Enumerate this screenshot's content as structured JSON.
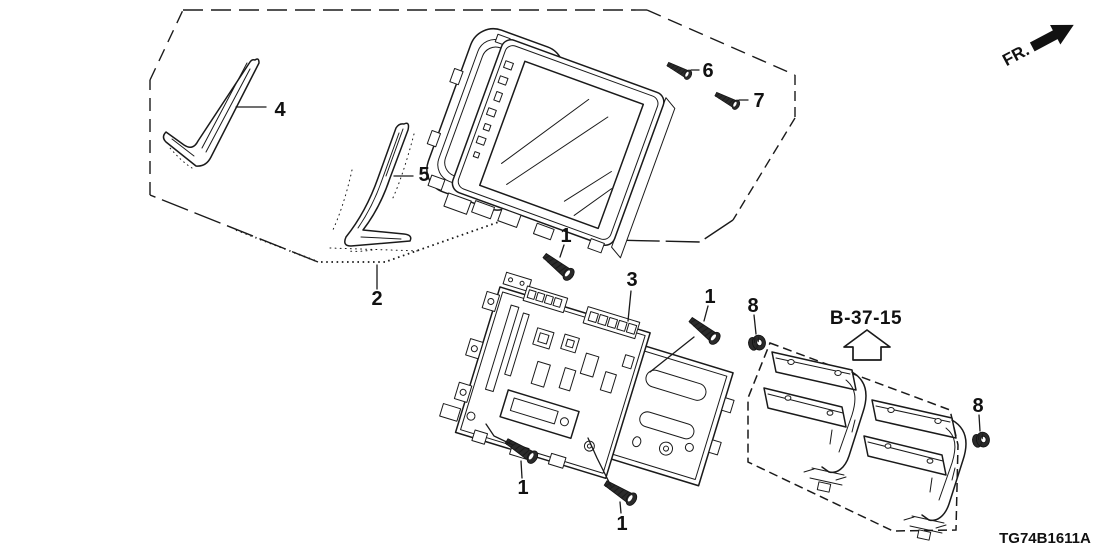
{
  "labels": {
    "part_1": "1",
    "part_2": "2",
    "part_3": "3",
    "part_4": "4",
    "part_5": "5",
    "part_6": "6",
    "part_7": "7",
    "part_8": "8"
  },
  "references": {
    "cross_reference": "B-37-15",
    "front_direction": "FR.",
    "diagram_code": "TG74B1611A"
  },
  "colors": {
    "line": "#1a1a1a",
    "background": "#ffffff"
  }
}
